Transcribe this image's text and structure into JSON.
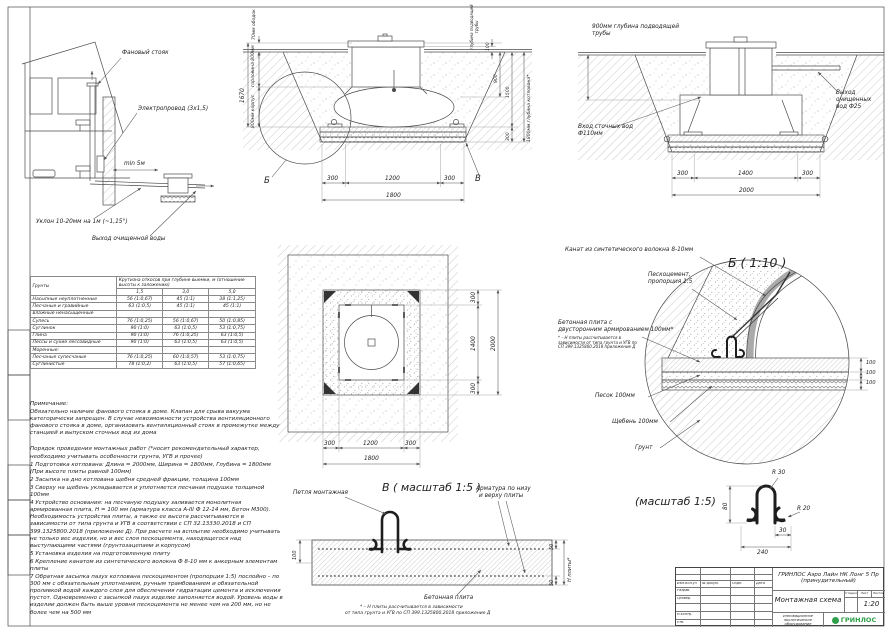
{
  "house": {
    "fan": "Фановый стояк",
    "electro": "Электропровод (3х1,5)",
    "min5": "min 5м",
    "slope": "Уклон 10-20мм на 1м (~1,15°)",
    "out": "Выход очищенной воды"
  },
  "s1": {
    "rim": "70мм ободок",
    "total": "1670",
    "neck": "горловина 800мм",
    "body": "800мм корпус",
    "pipe": "глубина подводящей трубы",
    "d100": "100",
    "d900": "900",
    "d1500": "1500",
    "d300": "300",
    "pit": "1800мм глубина котлована*",
    "b": "Б",
    "v": "В",
    "w1": "300",
    "w2": "1200",
    "w3": "300",
    "w": "1800"
  },
  "s2": {
    "pipe": "900мм глубина подводящей трубы",
    "inlet": "Вход сточных вод Ф110мм",
    "outlet": "Выход очищенных вод Ф25",
    "w1": "300",
    "w2": "1400",
    "w3": "300",
    "w": "2000"
  },
  "plan": {
    "h1": "300",
    "h2": "1400",
    "h3": "300",
    "h": "2000",
    "w1": "300",
    "w2": "1200",
    "w3": "300",
    "w": "1800"
  },
  "db": {
    "title": "Б ( 1:10 )",
    "rope": "Канат из синтетического волокна 8-10мм",
    "pc1": "Пескоцемент,",
    "pc2": "пропорция 1:5",
    "slab1": "Бетонная плита с",
    "slab2": "двусторонним армированием 100мм*",
    "fn": "* – Н плиты рассчитывается в зависимости от типа грунта и УГВ по СП 399.1325800.2018 приложение Д",
    "sand": "Песок 100мм",
    "gravel": "Щебень 100мм",
    "soil": "Грунт",
    "d1": "100",
    "d2": "100",
    "d3": "100"
  },
  "dv": {
    "title": "В ( масштаб 1:5 )",
    "loop": "Петля монтажная",
    "rebar1": "Арматура по низу",
    "rebar2": "и верху плиты",
    "slab": "Бетонная плита",
    "fn1": "* – Н плиты рассчитывается в зависимости",
    "fn2": "от типа грунта и УГВ по СП 399.1325800.2018 приложение Д",
    "d100": "100",
    "d50t": "50",
    "d50b": "50",
    "h": "Н плиты*"
  },
  "dl": {
    "title": "(масштаб 1:5)",
    "r30": "R 30",
    "r20": "R 20",
    "d80": "80",
    "d30": "30",
    "d240": "240"
  },
  "table": {
    "corner": "Грунты",
    "group": "Крутизна откосов при глубине выемки, м (отношение высоты к заложению)",
    "cols": [
      "1,5",
      "3,0",
      "5,0"
    ],
    "rows": [
      {
        "name": "Насыпные неуплотненные",
        "c": [
          "56 (1:0,67)",
          "45 (1:1)",
          "38 (1:1,25)"
        ]
      },
      {
        "name": "Песчаные и гравийные",
        "c": [
          "63 (1:0,5)",
          "45 (1:1)",
          "45 (1:1)"
        ]
      },
      {
        "name": "влажные ненасыщенные",
        "c": [
          "",
          "",
          ""
        ]
      },
      {
        "name": "Супесь",
        "c": [
          "76 (1:0,25)",
          "56 (1:0,67)",
          "50 (1:0,85)"
        ]
      },
      {
        "name": "Суглинок",
        "c": [
          "90 (1:0)",
          "63 (1:0,5)",
          "53 (1:0,75)"
        ]
      },
      {
        "name": "Глина",
        "c": [
          "90 (1:0)",
          "76 (1:0,25)",
          "63 (1:0,5)"
        ]
      },
      {
        "name": "Лессы и сухие лессовидные",
        "c": [
          "90 (1:0)",
          "63 (1:0,5)",
          "63 (1:0,5)"
        ]
      },
      {
        "name": "Моренные:",
        "c": [
          "",
          "",
          ""
        ]
      },
      {
        "name": "Песчаные супесчаные",
        "c": [
          "76 (1:0,25)",
          "60 (1:0,57)",
          "53 (1:0,75)"
        ]
      },
      {
        "name": "Суглинистые",
        "c": [
          "78 (1:0,2)",
          "63 (1:0,5)",
          "57 (1:0,65)"
        ]
      }
    ]
  },
  "notes": {
    "title": "Примечание:",
    "para1": "Обязательно наличие фанового стояка в доме. Клапан для срыва вакуума категорически запрещен. В случае невозможности устройства вентиляционного фанового стояка в доме, организовать вентиляционный стояк в промежутке между станцией и выпуском сточных вод из дома",
    "para2": "Порядок проведения монтажных работ (*носит рекомендательный характер, необходимо учитывать особенности грунта, УГВ и прочее)",
    "steps": [
      "1 Подготовка котлована: Длина = 2000мм,  Ширина = 1800мм, Глубина = 1800мм (При высоте плиты равной 100мм)",
      "2 Засыпка на дно котлована щебня средней фракции, толщина 100мм",
      "3 Сверху на щебень укладывается и уплотняется песчаная подушка толщиной 100мм",
      "4 Устройство основания: на песчаную подушку заливается монолитная армированная плита, Н = 100 мм (арматура класса А-III Ф 12-14 мм, Бетон М300). Необходимость устройства плиты, а также ее высота рассчитываются в зависимости от типа грунта и УГВ в соответствии с СП 32.13330.2018 и СП 399.1325800.2018 (приложение Д). При расчете на всплытие необходимо учитывать не только вес изделия, но и вес слоя пескоцемента, находящегося над выступающими частями (грунтозацепами и корпусом)",
      "5 Установка изделия на подготовленную плиту",
      "6 Крепление канатом из синтетического волокна Ф 8-10 мм к анкерным элементам плиты",
      "7 Обратная засыпка пазух котлована пескоцементом (пропорция 1:5) послойно – по 300 мм с обязательным уплотнением, ручным трамбованием и обязательной проливкой водой каждого слоя для обеспечения гидратации цемента и исключения пустот. Одновременно с засыпкой пазух изделие заполняется водой. Уровень воды в изделии должен быть выше уровня пескоцемента не менее чем на 200 мм, но не более чем на 500 мм"
    ]
  },
  "tb": {
    "doc_title": "ГРИНЛОС Аэро Лайн НК Лонг 5 Пр (принудительный)",
    "sheet_name": "Монтажная схема",
    "scale": "1:20",
    "col_izm": "Изм.Кол.уч",
    "col_doc": "№ докум.",
    "col_sign": "Подп.",
    "col_date": "Дата",
    "r1": "Разраб.",
    "r2": "Провер.",
    "r3": "",
    "r4": "Н.контр.",
    "r5": "Утв.",
    "st1": "Стадия",
    "st2": "Лист",
    "st3": "Листов",
    "tagline": "Инновационное экологическое оборудование",
    "brand": "ГРИНЛОС",
    "brand_color": "#2e9e49"
  }
}
